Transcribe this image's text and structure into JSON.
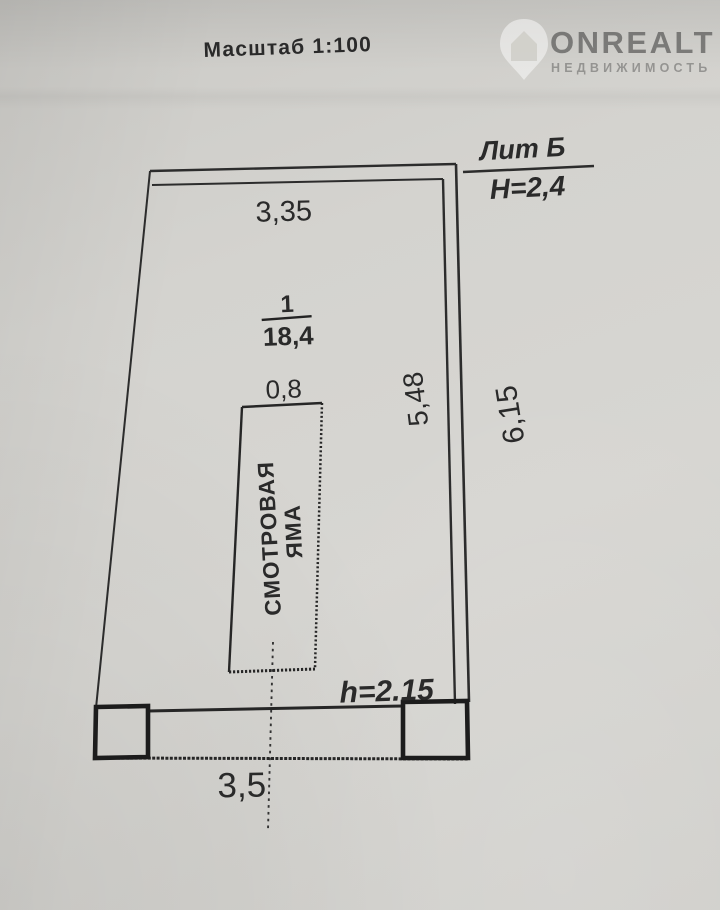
{
  "document": {
    "scale_label": "Масштаб 1:100",
    "watermark": {
      "icon": "house-pin-icon",
      "brand": "ONREALT",
      "subtitle": "НЕДВИЖИМОСТЬ"
    },
    "plan": {
      "liter_label": "Лит Б",
      "building_height": "H=2,4",
      "dim_top_width": "3,35",
      "room_number": "1",
      "room_area": "18,4",
      "dim_pit_width": "0,8",
      "pit_label_line1": "СМОТРОВАЯ",
      "pit_label_line2": "ЯМА",
      "dim_wall_inner": "5,48",
      "dim_wall_outer": "6,15",
      "pit_height": "h=2.15",
      "dim_bottom_width": "3,5"
    },
    "colors": {
      "paper": "#d3d2ce",
      "ink": "#2c2c2c",
      "watermark": "#ffffff"
    }
  }
}
